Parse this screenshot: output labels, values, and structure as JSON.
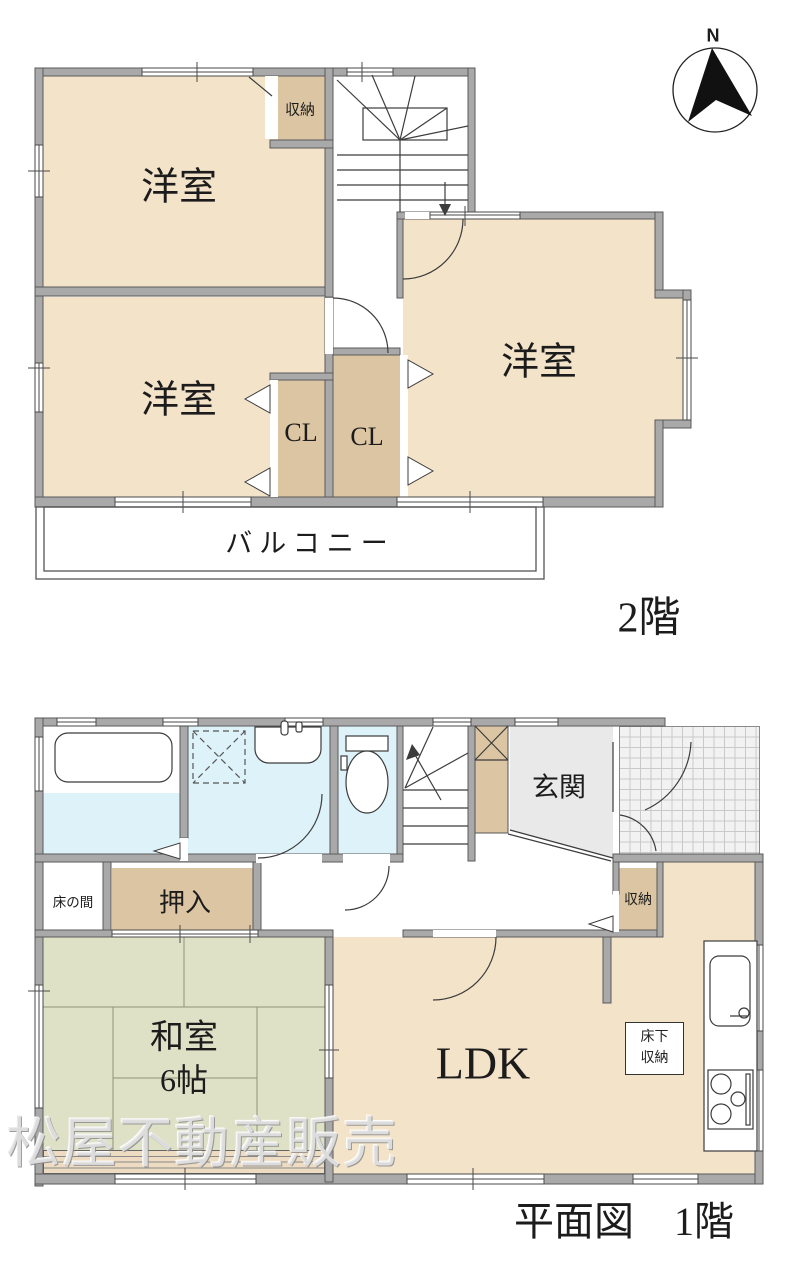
{
  "compass": {
    "north_label": "N"
  },
  "floor2": {
    "floor_label": "2階",
    "room_west_north": "洋室",
    "room_west_south": "洋室",
    "room_east": "洋室",
    "storage": "収納",
    "closet_left": "CL",
    "closet_right": "CL",
    "balcony": "バルコニー"
  },
  "floor1": {
    "floor_label": "平面図　1階",
    "entrance": "玄関",
    "storage": "収納",
    "oshiire": "押入",
    "tokonoma": "床の間",
    "washitsu": "和室",
    "washitsu_size": "6帖",
    "ldk": "LDK",
    "underfloor_storage_line1": "床下",
    "underfloor_storage_line2": "収納"
  },
  "watermark": "松屋不動産販売",
  "colors": {
    "wall": "#a9a9a9",
    "room_beige": "#f3e3c9",
    "closet_beige": "#dcc5a2",
    "tatami_green": "#dfe1c7",
    "water_blue": "#def2fa",
    "entry_gray": "#e9e9e9",
    "tile_gray": "#f2f2f2",
    "veranda_tan": "#eedcc2"
  }
}
